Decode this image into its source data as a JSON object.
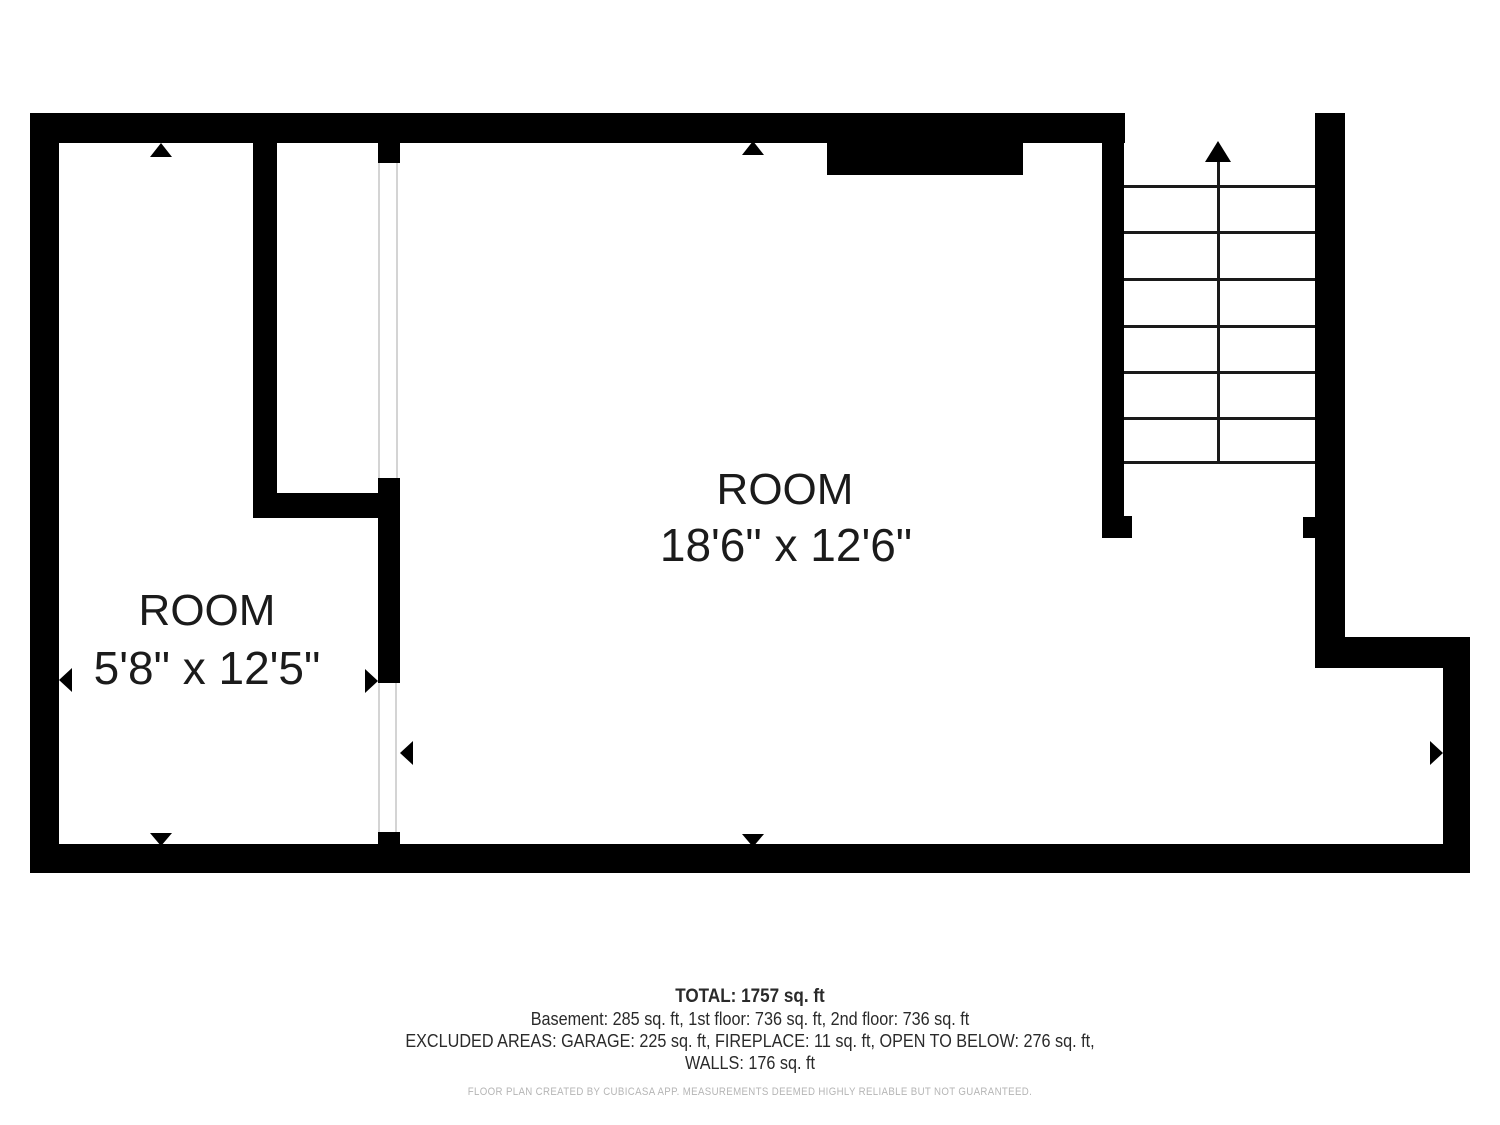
{
  "rooms": {
    "small": {
      "name": "ROOM",
      "dims": "5'8\" x 12'5\""
    },
    "large": {
      "name": "ROOM",
      "dims": "18'6\" x 12'6\""
    }
  },
  "summary": {
    "total": "TOTAL: 1757 sq. ft",
    "floors": "Basement: 285 sq. ft, 1st floor: 736 sq. ft, 2nd floor: 736 sq. ft",
    "excluded_line1": "EXCLUDED AREAS: GARAGE: 225 sq. ft, FIREPLACE: 11 sq. ft, OPEN TO BELOW: 276 sq. ft,",
    "excluded_line2": "WALLS: 176 sq. ft",
    "disclaimer": "FLOOR PLAN CREATED BY CUBICASA APP. MEASUREMENTS DEEMED HIGHLY RELIABLE BUT NOT GUARANTEED."
  },
  "colors": {
    "wall": "#000000",
    "label_text": "#1b1b1b",
    "summary_text": "#2a2a2a",
    "disclaimer_text": "#b5b5b5",
    "opening_line": "#d4d4d4"
  }
}
